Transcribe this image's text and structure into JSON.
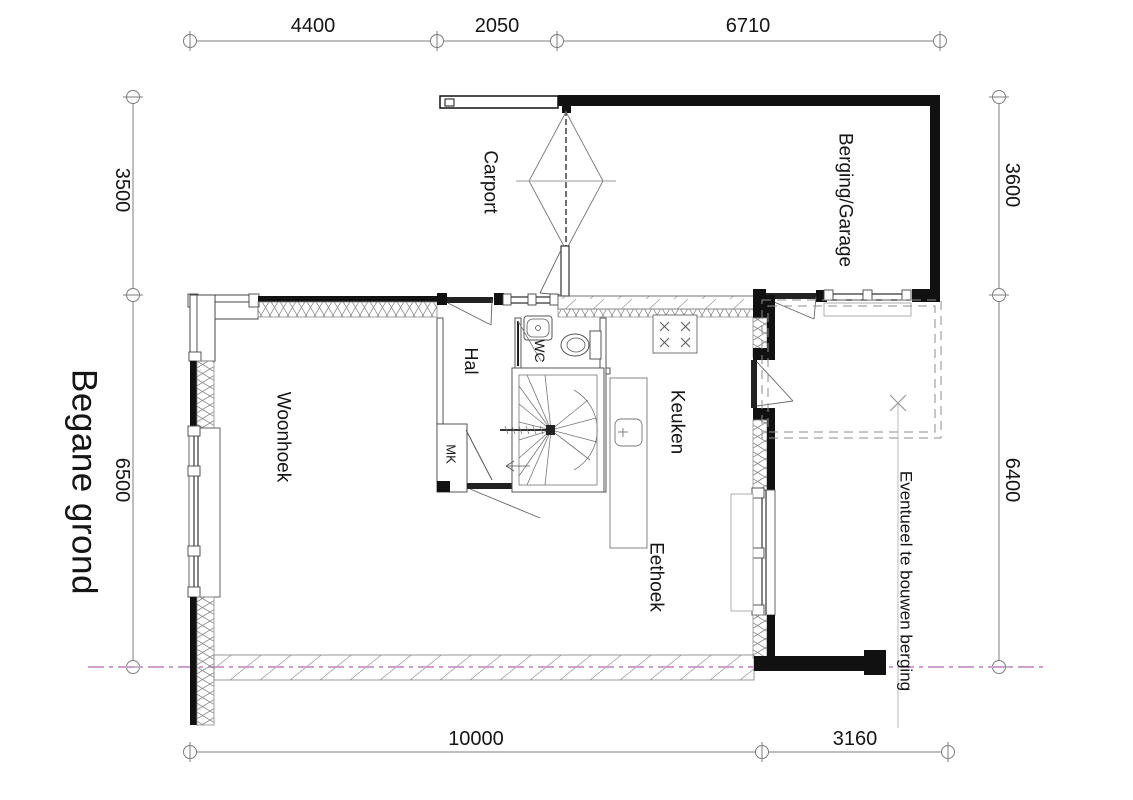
{
  "title": "Begane grond",
  "dimensions": {
    "top": [
      "4400",
      "2050",
      "6710"
    ],
    "left": [
      "3500",
      "6500"
    ],
    "right": [
      "3600",
      "6400"
    ],
    "bottom": [
      "10000",
      "3160"
    ]
  },
  "rooms": {
    "carport": "Carport",
    "berging_garage": "Berging/Garage",
    "hal": "Hal",
    "wc": "WC",
    "mk": "MK",
    "keuken": "Keuken",
    "woonhoek": "Woonhoek",
    "eethoek": "Eethoek",
    "future_berging": "Eventueel te bouwen berging"
  },
  "colors": {
    "wall": "#111111",
    "line": "#4a4a4a",
    "thin": "#888888",
    "hatch": "#999999",
    "pink": "#cf9fd0",
    "text": "#151515"
  }
}
